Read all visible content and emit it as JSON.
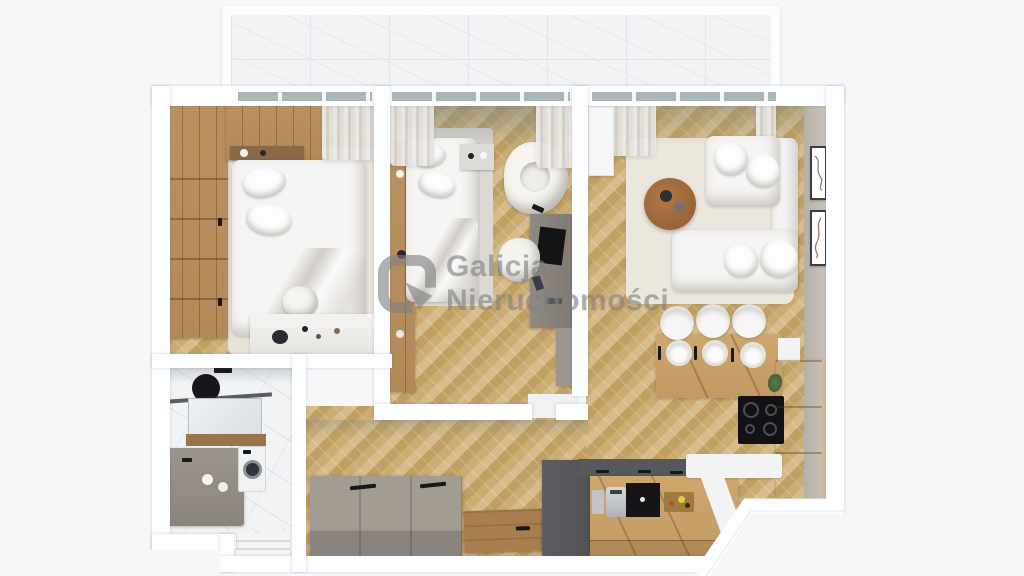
{
  "watermark": {
    "line1": "Galicja",
    "line2": "Nieruchomości"
  },
  "colors": {
    "bg": "#f6f7f9",
    "wall": "#fcfdfe",
    "wood_floor": "#cbac72",
    "wood_furniture": "#b28a58",
    "kitchen_wood": "#c19a63",
    "taupe": "#948d85",
    "dark_cabinet": "#57585c",
    "white_furniture": "#f6f5f3",
    "cream_rug": "#ece7dd",
    "marble": "#f2f3f5",
    "glass": "#aab5b6",
    "concrete_shade": "#8e9b9b",
    "beige_wall": "#b7b0a7",
    "plant_green": "#5a7a4a",
    "black": "#17181a",
    "watermark": "#808183"
  },
  "scene": {
    "description": "3D top-down rendering of a two-bedroom apartment floor plan",
    "rooms": [
      "balcony",
      "bedroom-1",
      "bedroom-2",
      "bathroom",
      "hallway",
      "living-room-with-kitchen"
    ]
  }
}
